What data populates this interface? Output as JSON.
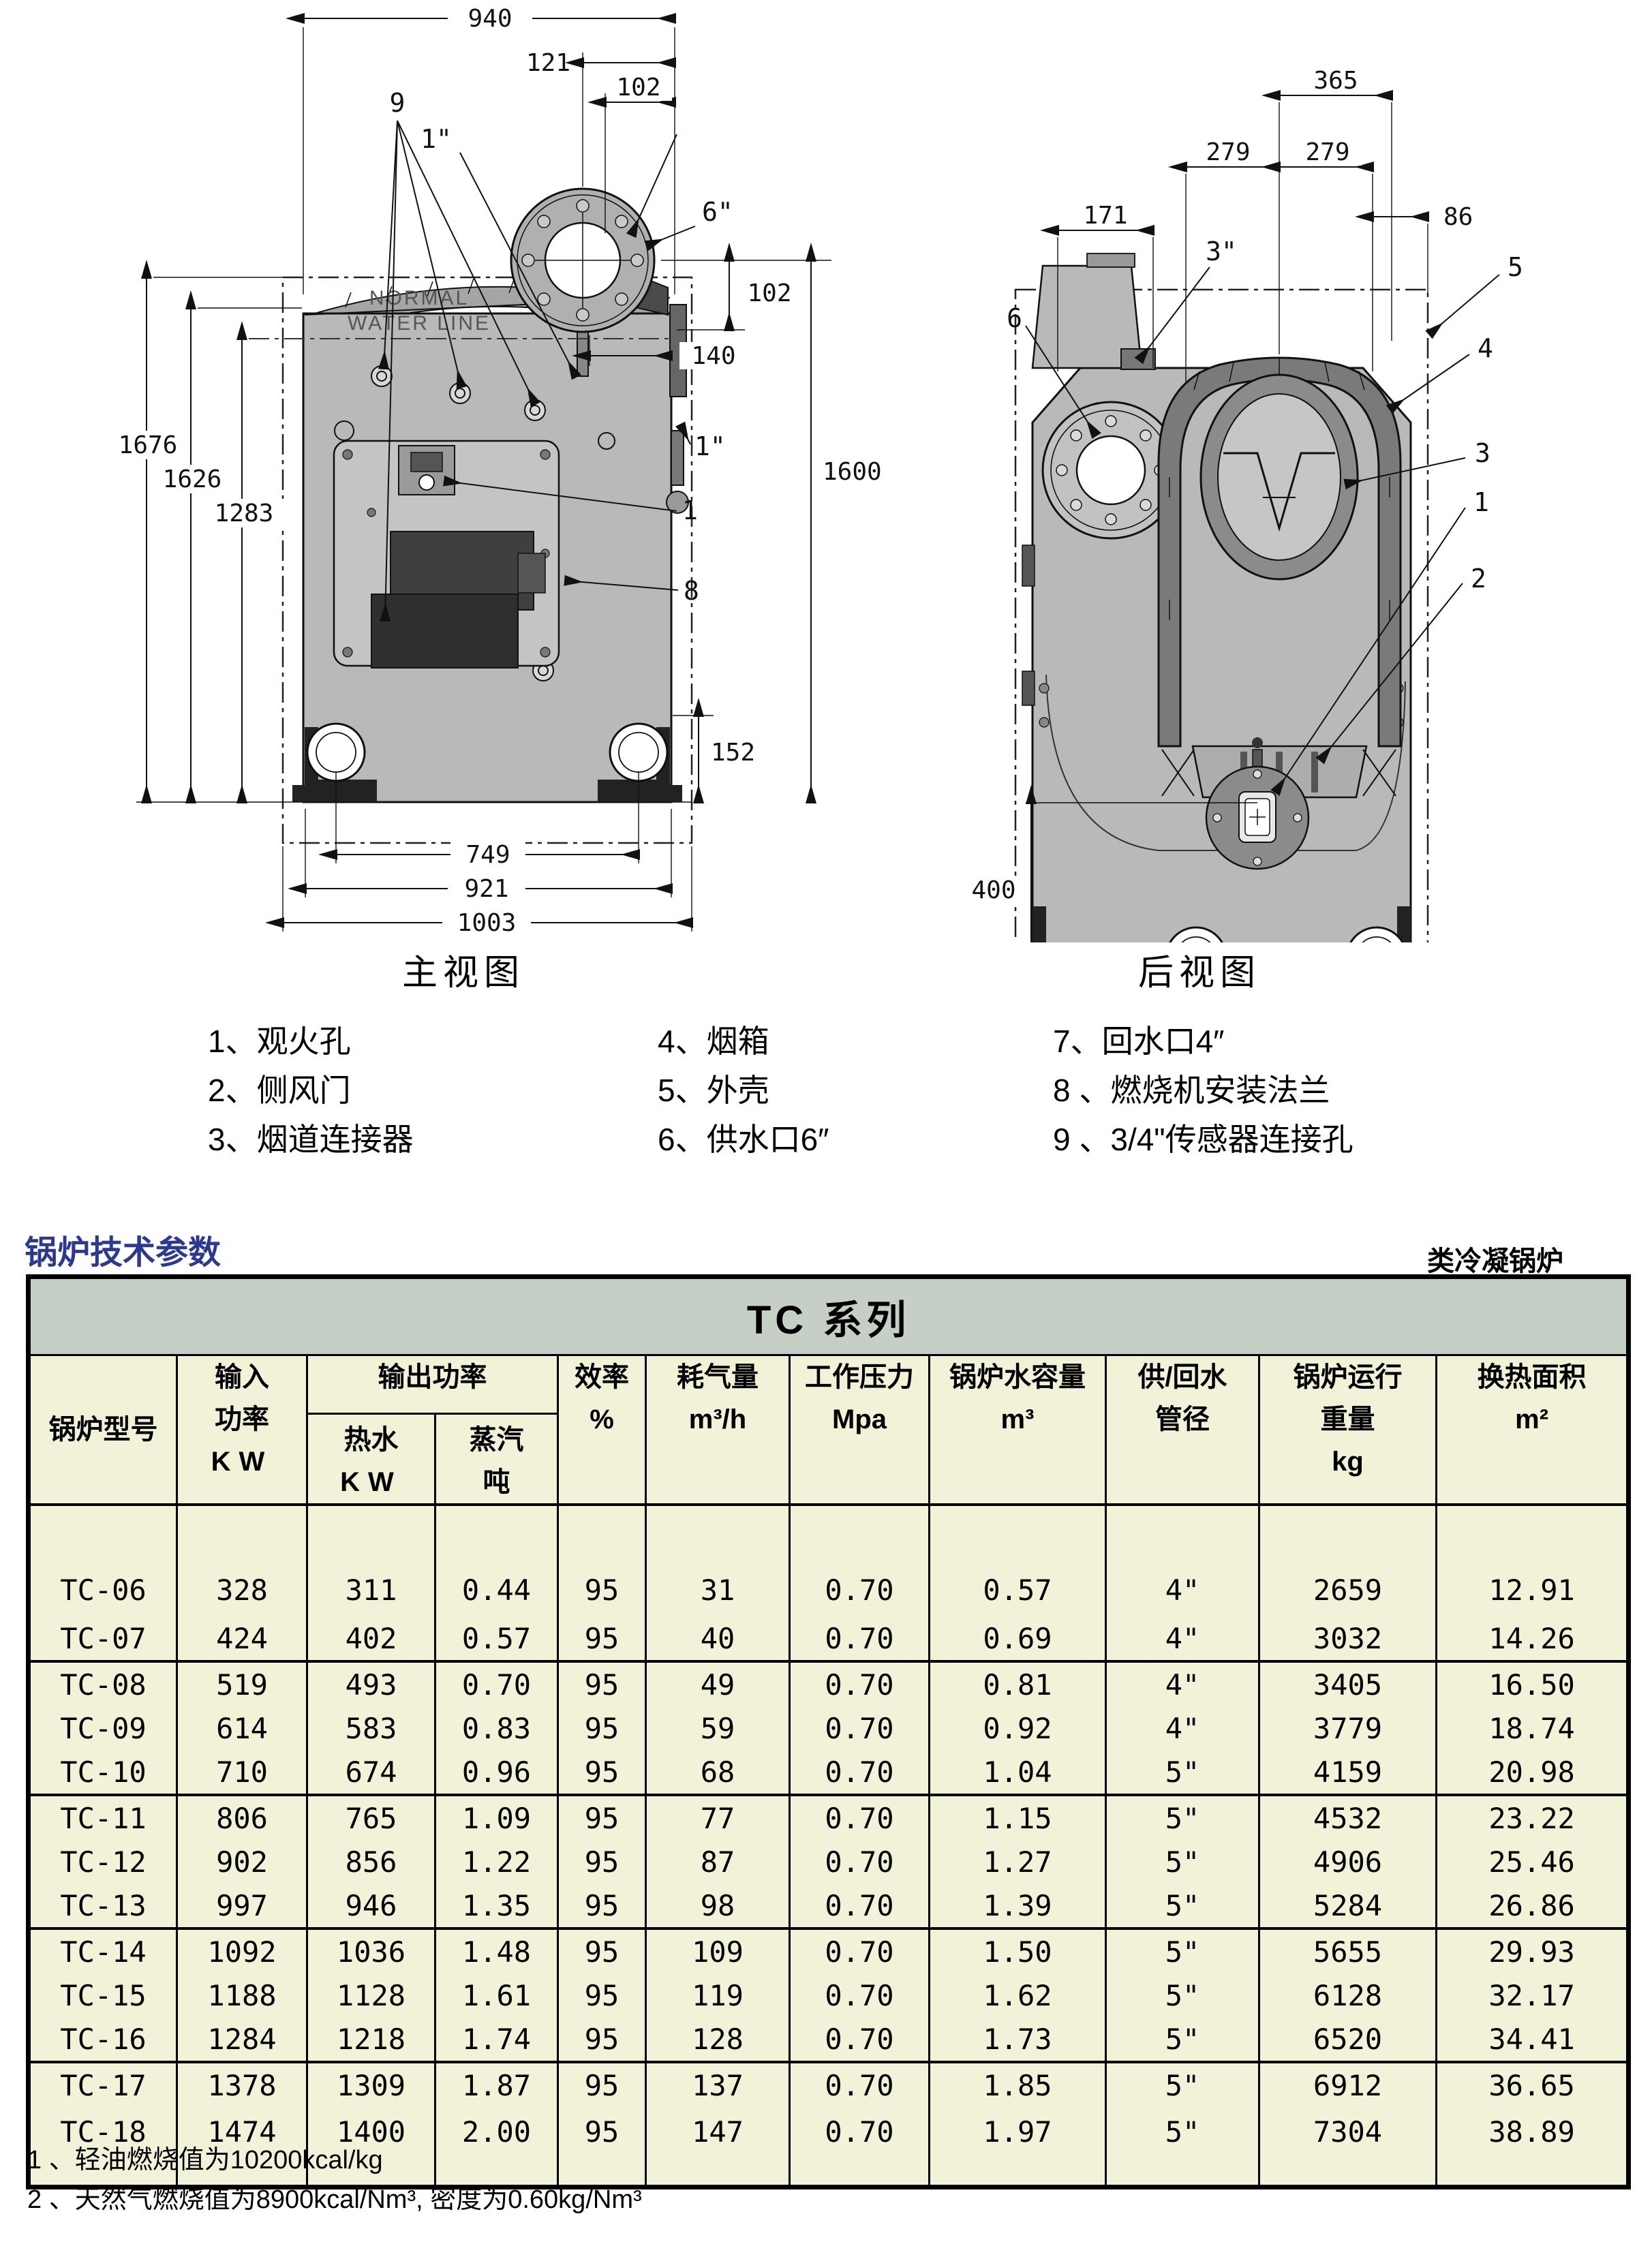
{
  "colors": {
    "accent_blue": "#2b3a90",
    "table_band_bg": "#c5cfc5",
    "table_body_bg": "#f2f2d8",
    "diagram_gray": "#b9b9b9",
    "line": "#000000"
  },
  "front_view": {
    "title": "主视图",
    "watermark_line1": "NORMAL",
    "watermark_line2": "WATER LINE",
    "dims": {
      "w940": "940",
      "w121": "121",
      "w102": "102",
      "n9": "9",
      "p1in_top": "1\"",
      "p6in": "6\"",
      "r102": "102",
      "r140": "140",
      "r1in": "1\"",
      "n1": "1",
      "n8": "8",
      "h1600": "1600",
      "h1676": "1676",
      "h1626": "1626",
      "h1283": "1283",
      "f152": "152",
      "b749": "749",
      "b921": "921",
      "b1003": "1003"
    }
  },
  "rear_view": {
    "title": "后视图",
    "dims": {
      "w365": "365",
      "w279a": "279",
      "w279b": "279",
      "w86": "86",
      "w171": "171",
      "p3in": "3\"",
      "n5": "5",
      "n6": "6",
      "n4": "4",
      "n3": "3",
      "n2": "2",
      "n1": "1",
      "n7": "7",
      "v400": "400"
    }
  },
  "legend": {
    "columns": [
      {
        "items": [
          "1、观火孔",
          "2、侧风门",
          "3、烟道连接器"
        ]
      },
      {
        "items": [
          "4、烟箱",
          "5、外壳",
          "6、供水口6″"
        ]
      },
      {
        "items": [
          "7、回水口4″",
          "8 、燃烧机安装法兰",
          "9 、3/4\"传感器连接孔"
        ]
      }
    ]
  },
  "section": {
    "title": "锅炉技术参数",
    "tag": "类冷凝锅炉"
  },
  "table": {
    "series_title": "TC 系列",
    "headers": {
      "model": "锅炉型号",
      "input": [
        "输入",
        "功率",
        "KW"
      ],
      "output_group": "输出功率",
      "hot_water": [
        "热水",
        "KW"
      ],
      "steam": [
        "蒸汽",
        "吨"
      ],
      "efficiency": [
        "效率",
        "%"
      ],
      "gas": [
        "耗气量",
        "m³/h"
      ],
      "pressure": [
        "工作压力",
        "Mpa"
      ],
      "volume": [
        "锅炉水容量",
        "m³"
      ],
      "pipe": [
        "供/回水",
        "管径"
      ],
      "weight": [
        "锅炉运行",
        "重量",
        "kg"
      ],
      "area": [
        "换热面积",
        "m²"
      ]
    },
    "rows": [
      [
        "TC-06",
        "328",
        "311",
        "0.44",
        "95",
        "31",
        "0.70",
        "0.57",
        "4\"",
        "2659",
        "12.91"
      ],
      [
        "TC-07",
        "424",
        "402",
        "0.57",
        "95",
        "40",
        "0.70",
        "0.69",
        "4\"",
        "3032",
        "14.26"
      ],
      [
        "TC-08",
        "519",
        "493",
        "0.70",
        "95",
        "49",
        "0.70",
        "0.81",
        "4\"",
        "3405",
        "16.50"
      ],
      [
        "TC-09",
        "614",
        "583",
        "0.83",
        "95",
        "59",
        "0.70",
        "0.92",
        "4\"",
        "3779",
        "18.74"
      ],
      [
        "TC-10",
        "710",
        "674",
        "0.96",
        "95",
        "68",
        "0.70",
        "1.04",
        "5\"",
        "4159",
        "20.98"
      ],
      [
        "TC-11",
        "806",
        "765",
        "1.09",
        "95",
        "77",
        "0.70",
        "1.15",
        "5\"",
        "4532",
        "23.22"
      ],
      [
        "TC-12",
        "902",
        "856",
        "1.22",
        "95",
        "87",
        "0.70",
        "1.27",
        "5\"",
        "4906",
        "25.46"
      ],
      [
        "TC-13",
        "997",
        "946",
        "1.35",
        "95",
        "98",
        "0.70",
        "1.39",
        "5\"",
        "5284",
        "26.86"
      ],
      [
        "TC-14",
        "1092",
        "1036",
        "1.48",
        "95",
        "109",
        "0.70",
        "1.50",
        "5\"",
        "5655",
        "29.93"
      ],
      [
        "TC-15",
        "1188",
        "1128",
        "1.61",
        "95",
        "119",
        "0.70",
        "1.62",
        "5\"",
        "6128",
        "32.17"
      ],
      [
        "TC-16",
        "1284",
        "1218",
        "1.74",
        "95",
        "128",
        "0.70",
        "1.73",
        "5\"",
        "6520",
        "34.41"
      ],
      [
        "TC-17",
        "1378",
        "1309",
        "1.87",
        "95",
        "137",
        "0.70",
        "1.85",
        "5\"",
        "6912",
        "36.65"
      ],
      [
        "TC-18",
        "1474",
        "1400",
        "2.00",
        "95",
        "147",
        "0.70",
        "1.97",
        "5\"",
        "7304",
        "38.89"
      ]
    ],
    "group_end_after": [
      "TC-07",
      "TC-10",
      "TC-13",
      "TC-16"
    ]
  },
  "footnotes": [
    "1 、轻油燃烧值为10200kcal/kg",
    "2 、天然气燃烧值为8900kcal/Nm³, 密度为0.60kg/Nm³"
  ]
}
